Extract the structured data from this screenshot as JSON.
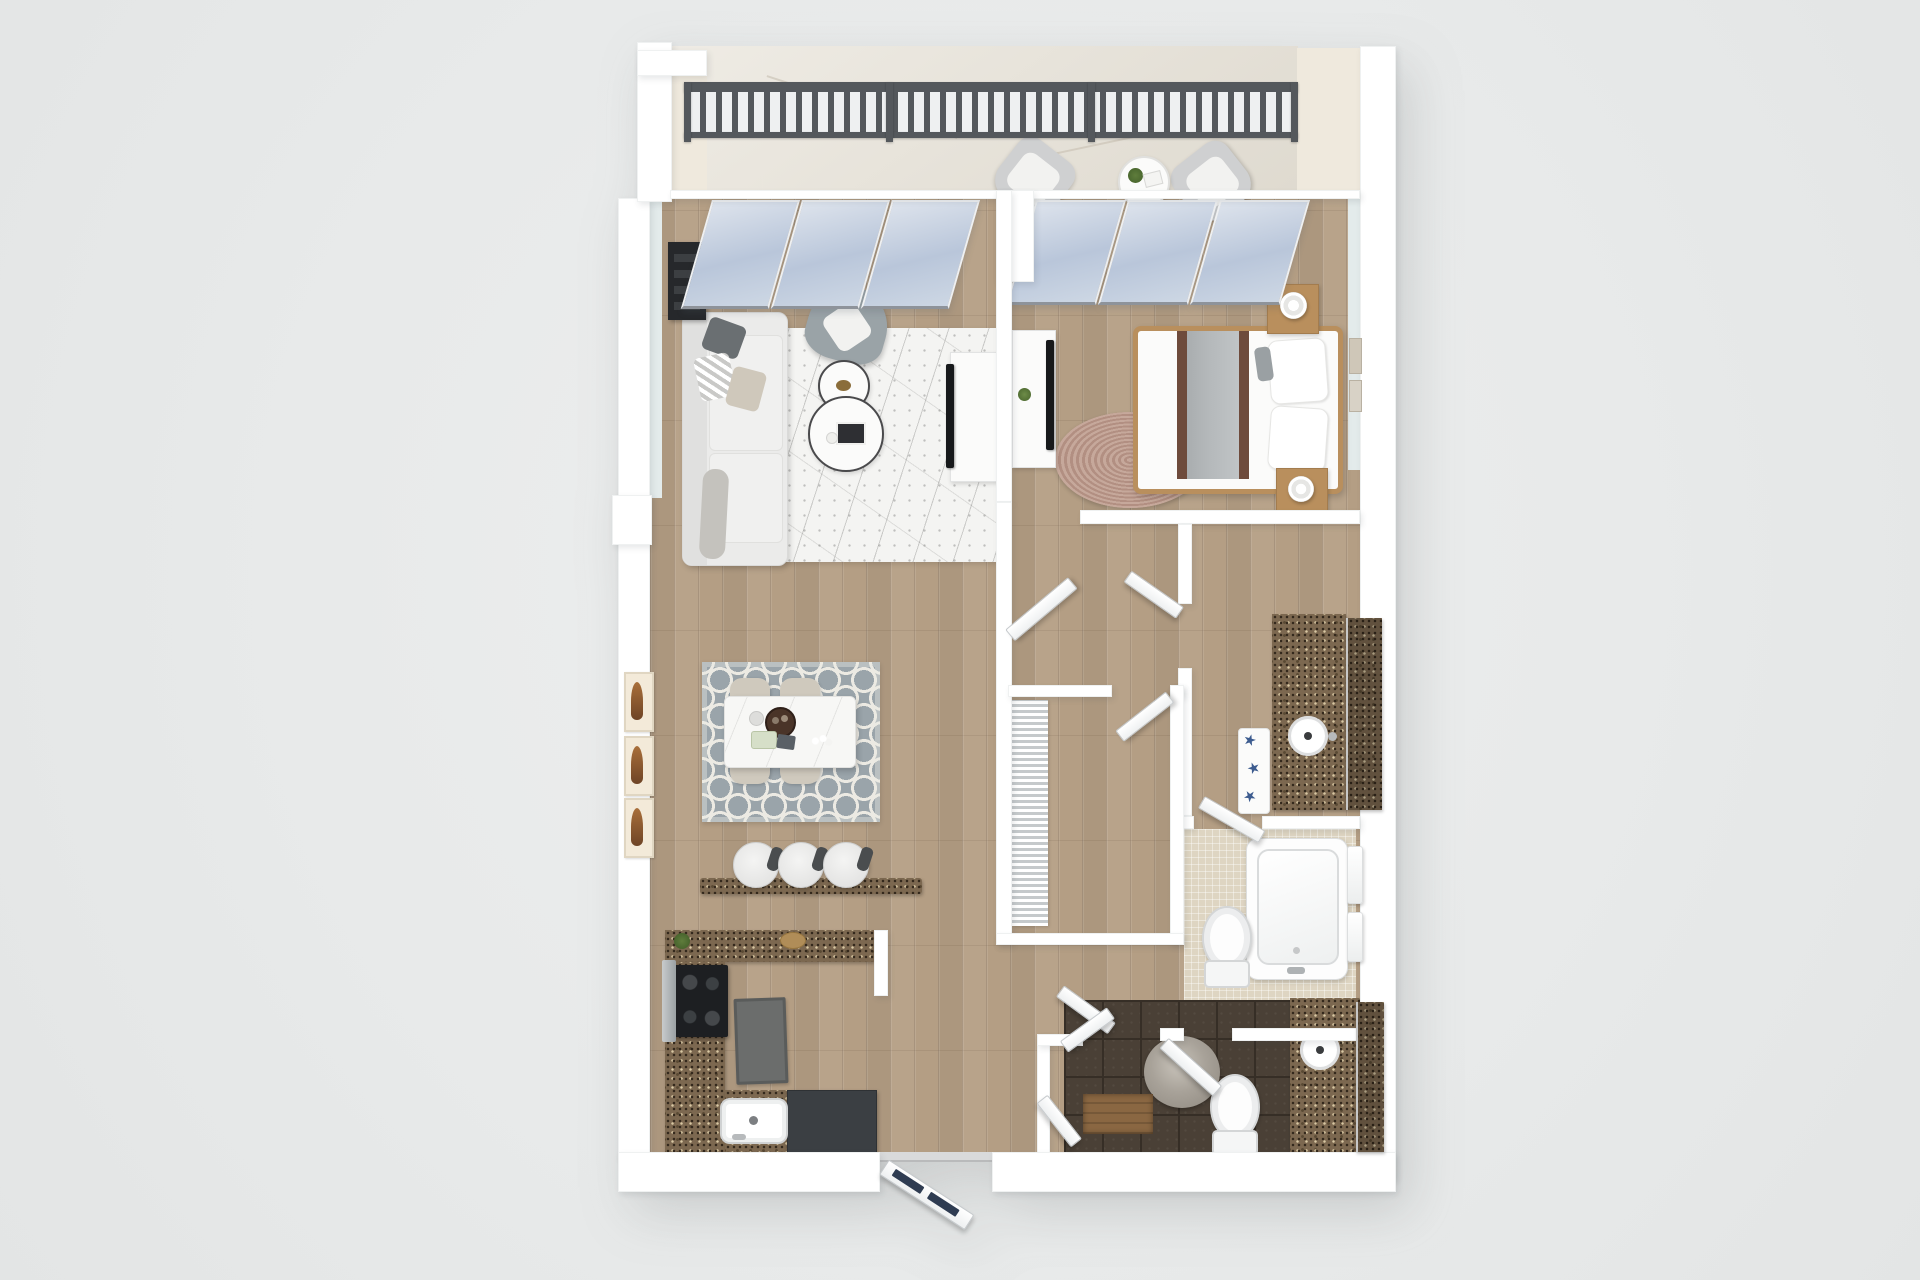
{
  "meta": {
    "image_kind": "3d-floor-plan-render",
    "view": "top-down dollhouse view of a one-bedroom apartment",
    "visible_text": "none"
  },
  "palette": {
    "page-bg": "#e8eaea",
    "wall": "#ffffff",
    "inner-face": "#e3ebeb",
    "cream": "#efe9dd",
    "wood": "#b49e84",
    "balcony-tile": "#e6e1d6",
    "glass-top": "#dde3ec",
    "glass-bottom": "#b9c6da",
    "railing": "#54585c",
    "marble-rug": "#f4f4f2",
    "trellis-base": "#9aa4aa",
    "trellis-line": "#eceae3",
    "jute1": "#c6a89b",
    "jute2": "#b28f82",
    "granite": "#7c6850",
    "granite-dark": "#32271b",
    "granite-light": "#d8c7a3",
    "mosaic": "#ded5c2",
    "dark-tile": "#4a4036",
    "dark-tile-line": "#362e26",
    "sofa": "#ebebea",
    "accent-chair": "#9aa3a7",
    "bed-wood": "#b98f5d",
    "bed-runner": "#b4b8ba",
    "bed-brown": "#6e4b3c",
    "black": "#17191b",
    "navy": "#2f3c52",
    "starfish": "#3d5c8f",
    "mat-gray": "#6b6d6c",
    "cabinet-dark": "#3b3f43",
    "chair-beige": "#cfc9bd",
    "art-orange": "#a96f3a"
  },
  "scene": {
    "rooms": [
      {
        "name": "balcony",
        "floor": "beige-tile",
        "items": [
          "metal-railing",
          "lounge-chair",
          "lounge-chair",
          "round-side-table",
          "potted-plant",
          "magazine"
        ]
      },
      {
        "name": "living-room",
        "floor": "wood-plank",
        "items": [
          "sofa-with-pillows",
          "gray-accent-chair",
          "round-nesting-coffee-tables",
          "white-marble-area-rug",
          "dark-bookshelf",
          "tv-console",
          "flat-tv",
          "sliding-glass-door"
        ]
      },
      {
        "name": "bedroom",
        "floor": "wood-plank",
        "items": [
          "queen-bed-white-bedding",
          "wood-nightstand-with-lamp",
          "wood-nightstand-with-lamp",
          "round-jute-rug",
          "tv-console",
          "flat-tv",
          "wall-art",
          "sliding-glass-door"
        ]
      },
      {
        "name": "dining-area",
        "floor": "wood-plank",
        "items": [
          "white-marble-dining-table",
          "dining-chair-x4",
          "gray-trellis-rug",
          "wall-art-x3",
          "table-decor"
        ]
      },
      {
        "name": "kitchen",
        "floor": "wood-plank",
        "items": [
          "l-shaped-granite-counter",
          "black-range-with-hood",
          "kitchen-sink",
          "dark-base-cabinet",
          "granite-breakfast-bar",
          "bar-stool-x3",
          "gray-floor-mat",
          "plant",
          "cutting-board"
        ]
      },
      {
        "name": "walk-in-closet",
        "floor": "wood-plank",
        "items": [
          "wire-shelving",
          "hinged-door"
        ]
      },
      {
        "name": "vanity-bathroom",
        "floor": "wood-plank",
        "items": [
          "granite-vanity",
          "round-sink",
          "mirror",
          "starfish-bath-mat",
          "hinged-door"
        ]
      },
      {
        "name": "tub-bathroom",
        "floor": "beige-mosaic-tile",
        "items": [
          "bathtub-with-faucet",
          "toilet",
          "hanging-towels",
          "hinged-door"
        ]
      },
      {
        "name": "second-bathroom",
        "floor": "dark-brown-tile",
        "items": [
          "granite-vanity",
          "round-sink",
          "mirror",
          "toilet",
          "round-gray-rug",
          "wood-linen-shelf",
          "bifold-doors"
        ]
      },
      {
        "name": "entry-hall",
        "floor": "wood-plank",
        "items": [
          "front-door-navy-panels",
          "threshold"
        ]
      }
    ],
    "counts": {
      "bedrooms": 1,
      "bathrooms": 3,
      "balconies": 1,
      "sliding_glass_doors": 2,
      "interior_doors": 7
    }
  }
}
